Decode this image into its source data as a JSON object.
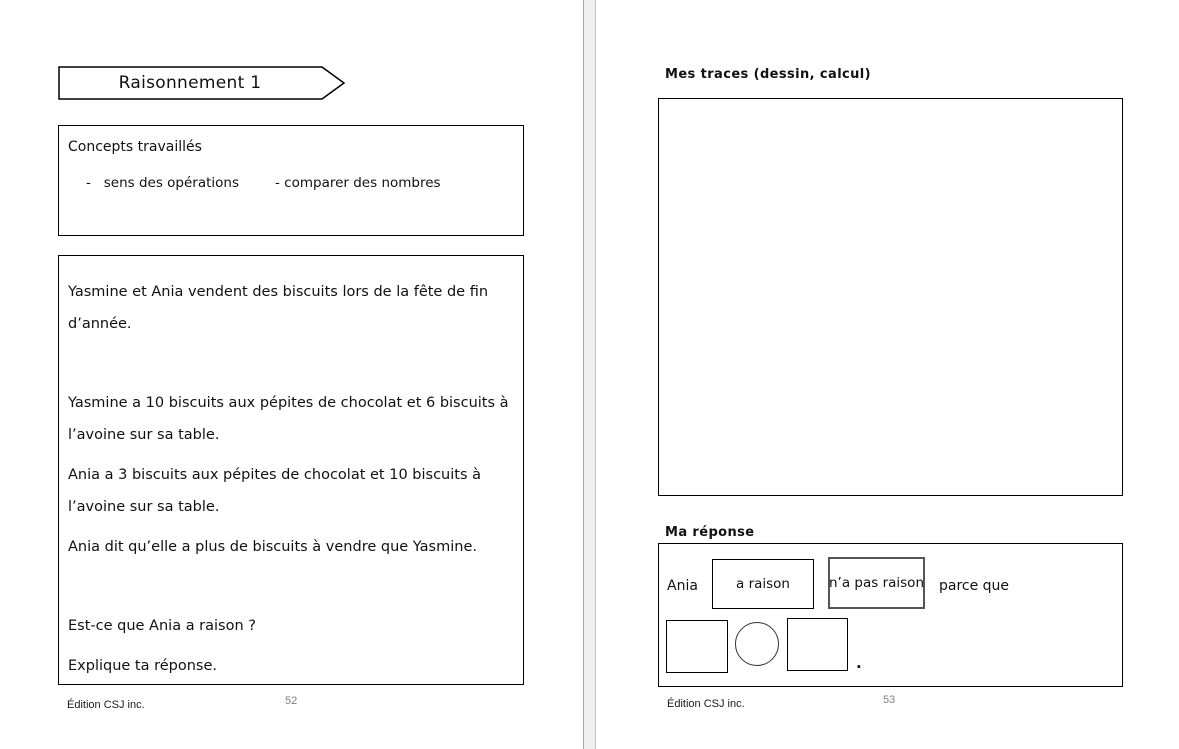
{
  "left_page": {
    "banner": {
      "title": "Raisonnement 1"
    },
    "concepts_box": {
      "heading": "Concepts travaillés",
      "item_1": "-   sens des opérations",
      "item_2": "- comparer des nombres"
    },
    "problem_box": {
      "lines": [
        "Yasmine et Ania vendent des biscuits lors de la fête de fin",
        "d’année.",
        "Yasmine a 10 biscuits aux pépites de chocolat et 6 biscuits à",
        "l’avoine sur sa table.",
        "Ania a 3 biscuits aux pépites de chocolat et 10 biscuits à",
        "l’avoine sur sa table.",
        "Ania dit qu’elle a plus de biscuits à vendre que Yasmine.",
        "Est-ce que Ania a raison ?",
        "Explique ta réponse."
      ]
    },
    "footer": {
      "publisher": "Édition CSJ inc.",
      "page_number": "52"
    }
  },
  "right_page": {
    "traces_heading": "Mes traces (dessin, calcul)",
    "response": {
      "heading": "Ma réponse",
      "subject": "Ania",
      "option_correct": "a raison",
      "option_incorrect": "n’a pas raison",
      "connector": "parce que",
      "period": "."
    },
    "footer": {
      "publisher": "Édition CSJ inc.",
      "page_number": "53"
    }
  },
  "colors": {
    "page_background": "#ffffff",
    "border": "#000000",
    "incorrect_option_border": "#555555",
    "divider_fill": "#efefef",
    "page_number_gray": "#808080"
  }
}
